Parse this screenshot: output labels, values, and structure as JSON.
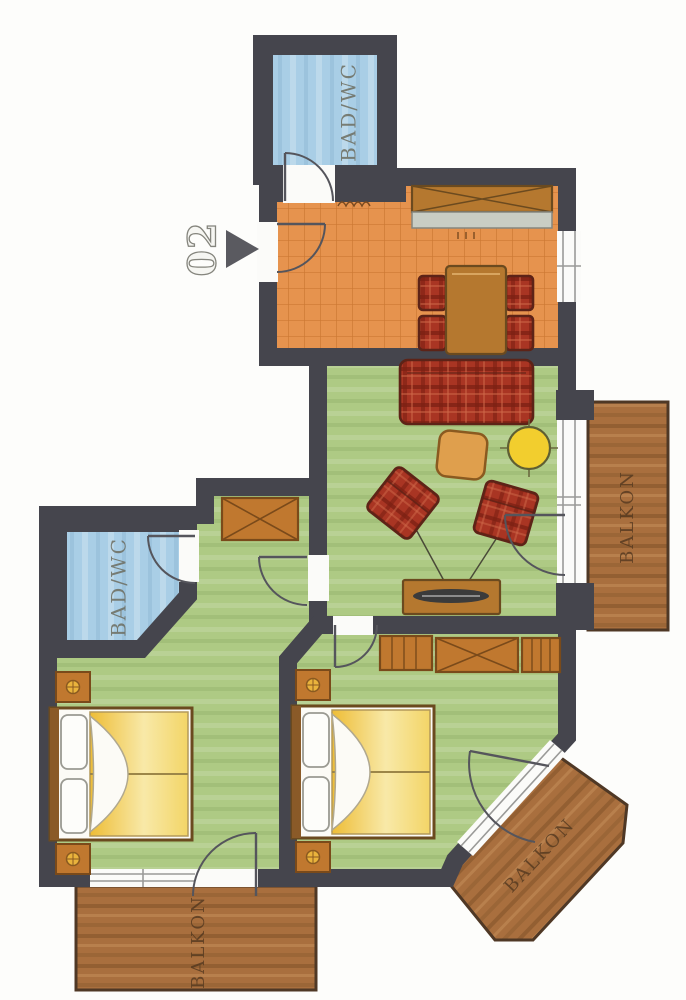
{
  "plan": {
    "unit_label": "02",
    "rooms": {
      "bath_top_label": "BAD/WC",
      "bath_left_label": "BAD/WC",
      "balcony_right_label": "BALKON",
      "balcony_bottom_label": "BALKON",
      "balcony_corner_label": "BALKON"
    },
    "colors": {
      "wall": "#45454d",
      "bath_floor": "#a9cee6",
      "tile_floor": "#e6934e",
      "tile_grid": "#c4702c",
      "living_floor": "#aeca84",
      "balcony_wood": "#a96f3e",
      "upholstery_red": "#a93523",
      "duvet_yellow": "#f2cd52",
      "furniture_brown": "#b5782f",
      "counter_gray": "#c9cdc4",
      "accent_table_yellow": "#f2ce2e"
    },
    "furniture_icons": [
      "double-bed",
      "nightstand",
      "wardrobe",
      "kitchen-counter",
      "dining-table",
      "dining-chair",
      "sofa",
      "armchair",
      "ottoman",
      "round-table",
      "tv-sideboard"
    ]
  }
}
